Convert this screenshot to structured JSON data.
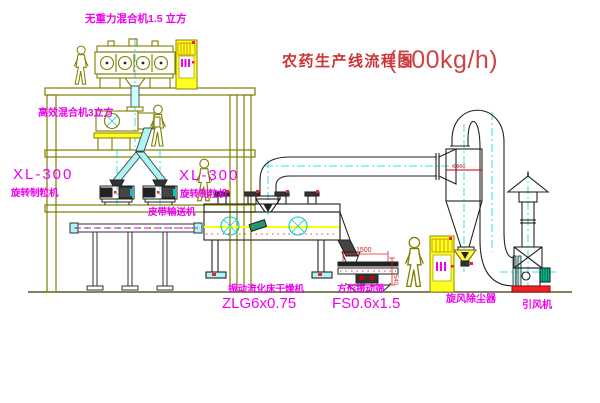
{
  "title": {
    "name": "农药生产线流程图",
    "capacity": "(500kg/h)"
  },
  "equipment_labels": {
    "gravity_free_mixer": "无重力混合机1.5 立方",
    "high_efficiency_mixer": "高效混合机3立方",
    "granulator_left_model": "XL-300",
    "granulator_left_name": "旋转制粒机",
    "granulator_mid_model": "XL-300",
    "granulator_mid_name": "旋转制粒机",
    "belt_conveyor": "皮带输送机",
    "fluid_bed_dryer_name": "振动流化床干燥机",
    "fluid_bed_dryer_model": "ZLG6x0.75",
    "vibrating_screen_name": "方形振动筛",
    "vibrating_screen_model": "FS0.6x1.5",
    "cyclone_dust_collector": "旋风除尘器",
    "induced_draft_fan": "引风机"
  },
  "dimensions": {
    "screen_length": "1500",
    "screen_height": "540",
    "cyclone_note": "Φ600"
  },
  "colors": {
    "structure_olive": "#7f7f00",
    "label_magenta": "#ee00ee",
    "title_red": "#cc3333",
    "centerline_cyan": "#00dddd",
    "highlight_yellow": "#ffff22",
    "accent_red": "#ee2222"
  }
}
